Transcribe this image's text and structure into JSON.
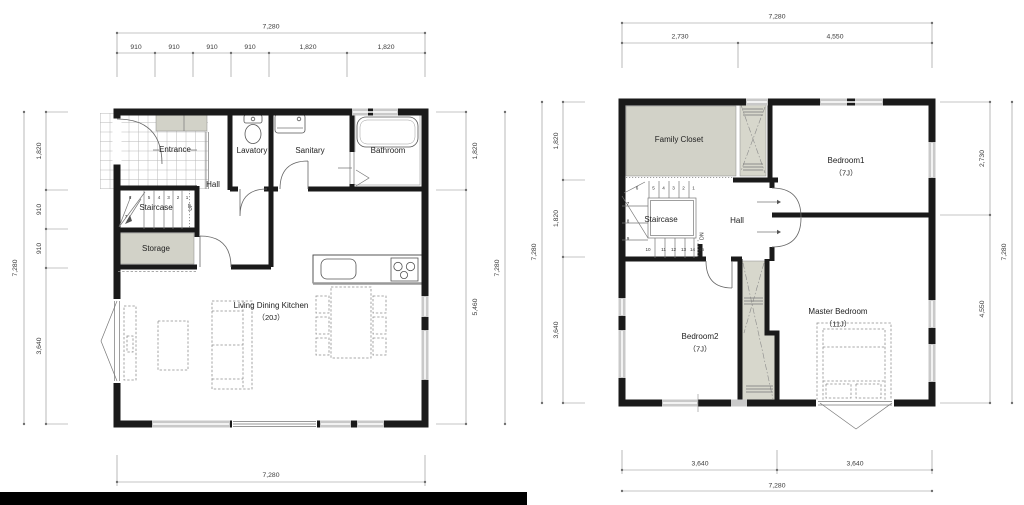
{
  "colors": {
    "wall": "#1a1a1a",
    "room_fill": "#d2d2c8",
    "closet_fill": "#d7d7cc",
    "window": "#c9c9c9",
    "dim_line": "#8a8a8a"
  },
  "floor1": {
    "rooms": {
      "entrance": "Entrance",
      "lavatory": "Lavatory",
      "sanitary": "Sanitary",
      "bathroom": "Bathroom",
      "hall": "Hall",
      "staircase": "Staircase",
      "storage": "Storage",
      "ldk": "Living Dining Kitchen",
      "ldk_size": "（20J）"
    },
    "stairs": {
      "numbers": [
        "6",
        "5",
        "4",
        "3",
        "2",
        "1"
      ],
      "winder": "7",
      "direction": "UP"
    },
    "dims": {
      "top_total": "7,280",
      "top_segments": [
        "910",
        "910",
        "910",
        "910",
        "1,820",
        "1,820"
      ],
      "left_total": "7,280",
      "left_segments": [
        "1,820",
        "910",
        "910",
        "3,640"
      ],
      "right_total": "7,280",
      "right_segments": [
        "1,820",
        "5,460"
      ],
      "bottom_total": "7,280"
    }
  },
  "floor2": {
    "rooms": {
      "family_closet": "Family Closet",
      "bedroom1": "Bedroom1",
      "bedroom1_size": "（7J）",
      "hall": "Hall",
      "staircase": "Staircase",
      "bedroom2": "Bedroom2",
      "bedroom2_size": "（7J）",
      "master_bedroom": "Master Bedroom",
      "master_bedroom_size": "（11J）"
    },
    "stairs": {
      "top_numbers": [
        "6",
        "5",
        "4",
        "3",
        "2",
        "1"
      ],
      "left_numbers": [
        "7",
        "8",
        "9"
      ],
      "bottom_numbers": [
        "10",
        "11",
        "12",
        "13",
        "14",
        "15"
      ],
      "direction": "DN"
    },
    "dims": {
      "top_total": "7,280",
      "top_segments": [
        "2,730",
        "4,550"
      ],
      "left_total": "7,280",
      "left_segments": [
        "1,820",
        "1,820",
        "3,640"
      ],
      "right_total": "7,280",
      "right_segments": [
        "2,730",
        "4,550"
      ],
      "bottom_total": "7,280",
      "bottom_segments": [
        "3,640",
        "3,640"
      ]
    }
  }
}
